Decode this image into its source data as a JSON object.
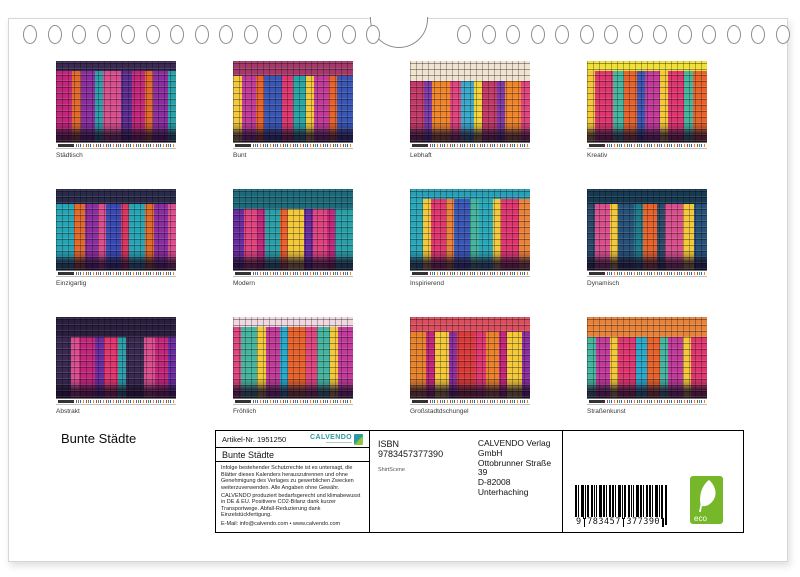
{
  "page": {
    "title": "Bunte Städte"
  },
  "thumbnails": [
    {
      "label": "Städtisch",
      "sky": "#3a2a52",
      "palette": [
        "#c2277b",
        "#e06a2a",
        "#8a2ea0",
        "#2a9fa8",
        "#d94f8e",
        "#5b2d8f"
      ]
    },
    {
      "label": "Bunt",
      "sky": "#a33a6a",
      "palette": [
        "#e0366f",
        "#28a5a5",
        "#f3c93a",
        "#c23a9a",
        "#e8632c",
        "#3a57b5"
      ]
    },
    {
      "label": "Lebhaft",
      "sky": "#f0e3d0",
      "palette": [
        "#f0862c",
        "#e0447f",
        "#3aa8c9",
        "#f3d23a",
        "#c23a68",
        "#7a3aa8"
      ]
    },
    {
      "label": "Kreativ",
      "sky": "#f0e13a",
      "palette": [
        "#f3c93a",
        "#e0366f",
        "#46b5a0",
        "#e8632c",
        "#3a57b5",
        "#c23a9a"
      ]
    },
    {
      "label": "Einzigartig",
      "sky": "#2a2a4a",
      "palette": [
        "#3a4ab5",
        "#d9365f",
        "#28a5b5",
        "#e06a2a",
        "#8a2ea0",
        "#d94f8e"
      ]
    },
    {
      "label": "Modern",
      "sky": "#1f6a7a",
      "palette": [
        "#c2277b",
        "#2a9fa8",
        "#e8632c",
        "#f3c93a",
        "#6a2d9f",
        "#e0447f"
      ]
    },
    {
      "label": "Inspirierend",
      "sky": "#2a9fb5",
      "palette": [
        "#2aa8b8",
        "#f3c93a",
        "#e0366f",
        "#e8833c",
        "#3a57b5",
        "#46b5a0"
      ]
    },
    {
      "label": "Dynamisch",
      "sky": "#173a52",
      "palette": [
        "#1f7a8a",
        "#e8632c",
        "#2a4a6a",
        "#d94f8e",
        "#f3c93a",
        "#28527a"
      ]
    },
    {
      "label": "Abstrakt",
      "sky": "#2a1f3f",
      "palette": [
        "#c2277b",
        "#6a2d9f",
        "#e0366f",
        "#2a9fa8",
        "#3a2a52",
        "#d94f8e"
      ]
    },
    {
      "label": "Fröhlich",
      "sky": "#f0d8e0",
      "palette": [
        "#e0447f",
        "#46b5a0",
        "#f3c93a",
        "#c23a9a",
        "#2aa8c9",
        "#e8632c"
      ]
    },
    {
      "label": "Großstadtdschungel",
      "sky": "#d94f5f",
      "palette": [
        "#d93a3a",
        "#e0366f",
        "#e8832c",
        "#c2277b",
        "#f3c93a",
        "#8a2ea0"
      ]
    },
    {
      "label": "Straßenkunst",
      "sky": "#e8833c",
      "palette": [
        "#f3c93a",
        "#e0366f",
        "#2aa8c9",
        "#e8632c",
        "#46b5a0",
        "#c23a9a"
      ]
    }
  ],
  "info_box": {
    "article_label": "Artikel-Nr. 1951250",
    "brand": "CALVENDO",
    "calendar_title": "Bunte Städte",
    "legal_paragraphs": [
      "Infolge bestehender Schutzrechte ist es untersagt, die Blätter dieses Kalenders herauszutrennen und ohne Genehmigung des Verlages zu gewerblichen Zwecken weiterzuverwenden. Alle Angaben ohne Gewähr.",
      "CALVENDO produziert bedarfsgerecht und klimabewusst in DE & EU. Positivere CO2-Bilanz dank kurzer Transportwege. Abfall-Reduzierung dank Einzelstückfertigung.",
      "E-Mail: info@calvendo.com • www.calvendo.com"
    ]
  },
  "publisher": {
    "isbn": "ISBN 9783457377390",
    "credit": "ShirtScene",
    "name": "CALVENDO Verlag GmbH",
    "street": "Ottobrunner Straße 39",
    "city": "D-82008 Unterhaching"
  },
  "barcode": {
    "digit_lead": "9",
    "digits_left": "783457",
    "digits_right": "377390",
    "eco_label": "eco"
  },
  "colors": {
    "brand_teal": "#2d9aa0",
    "eco_green": "#76b82a"
  }
}
